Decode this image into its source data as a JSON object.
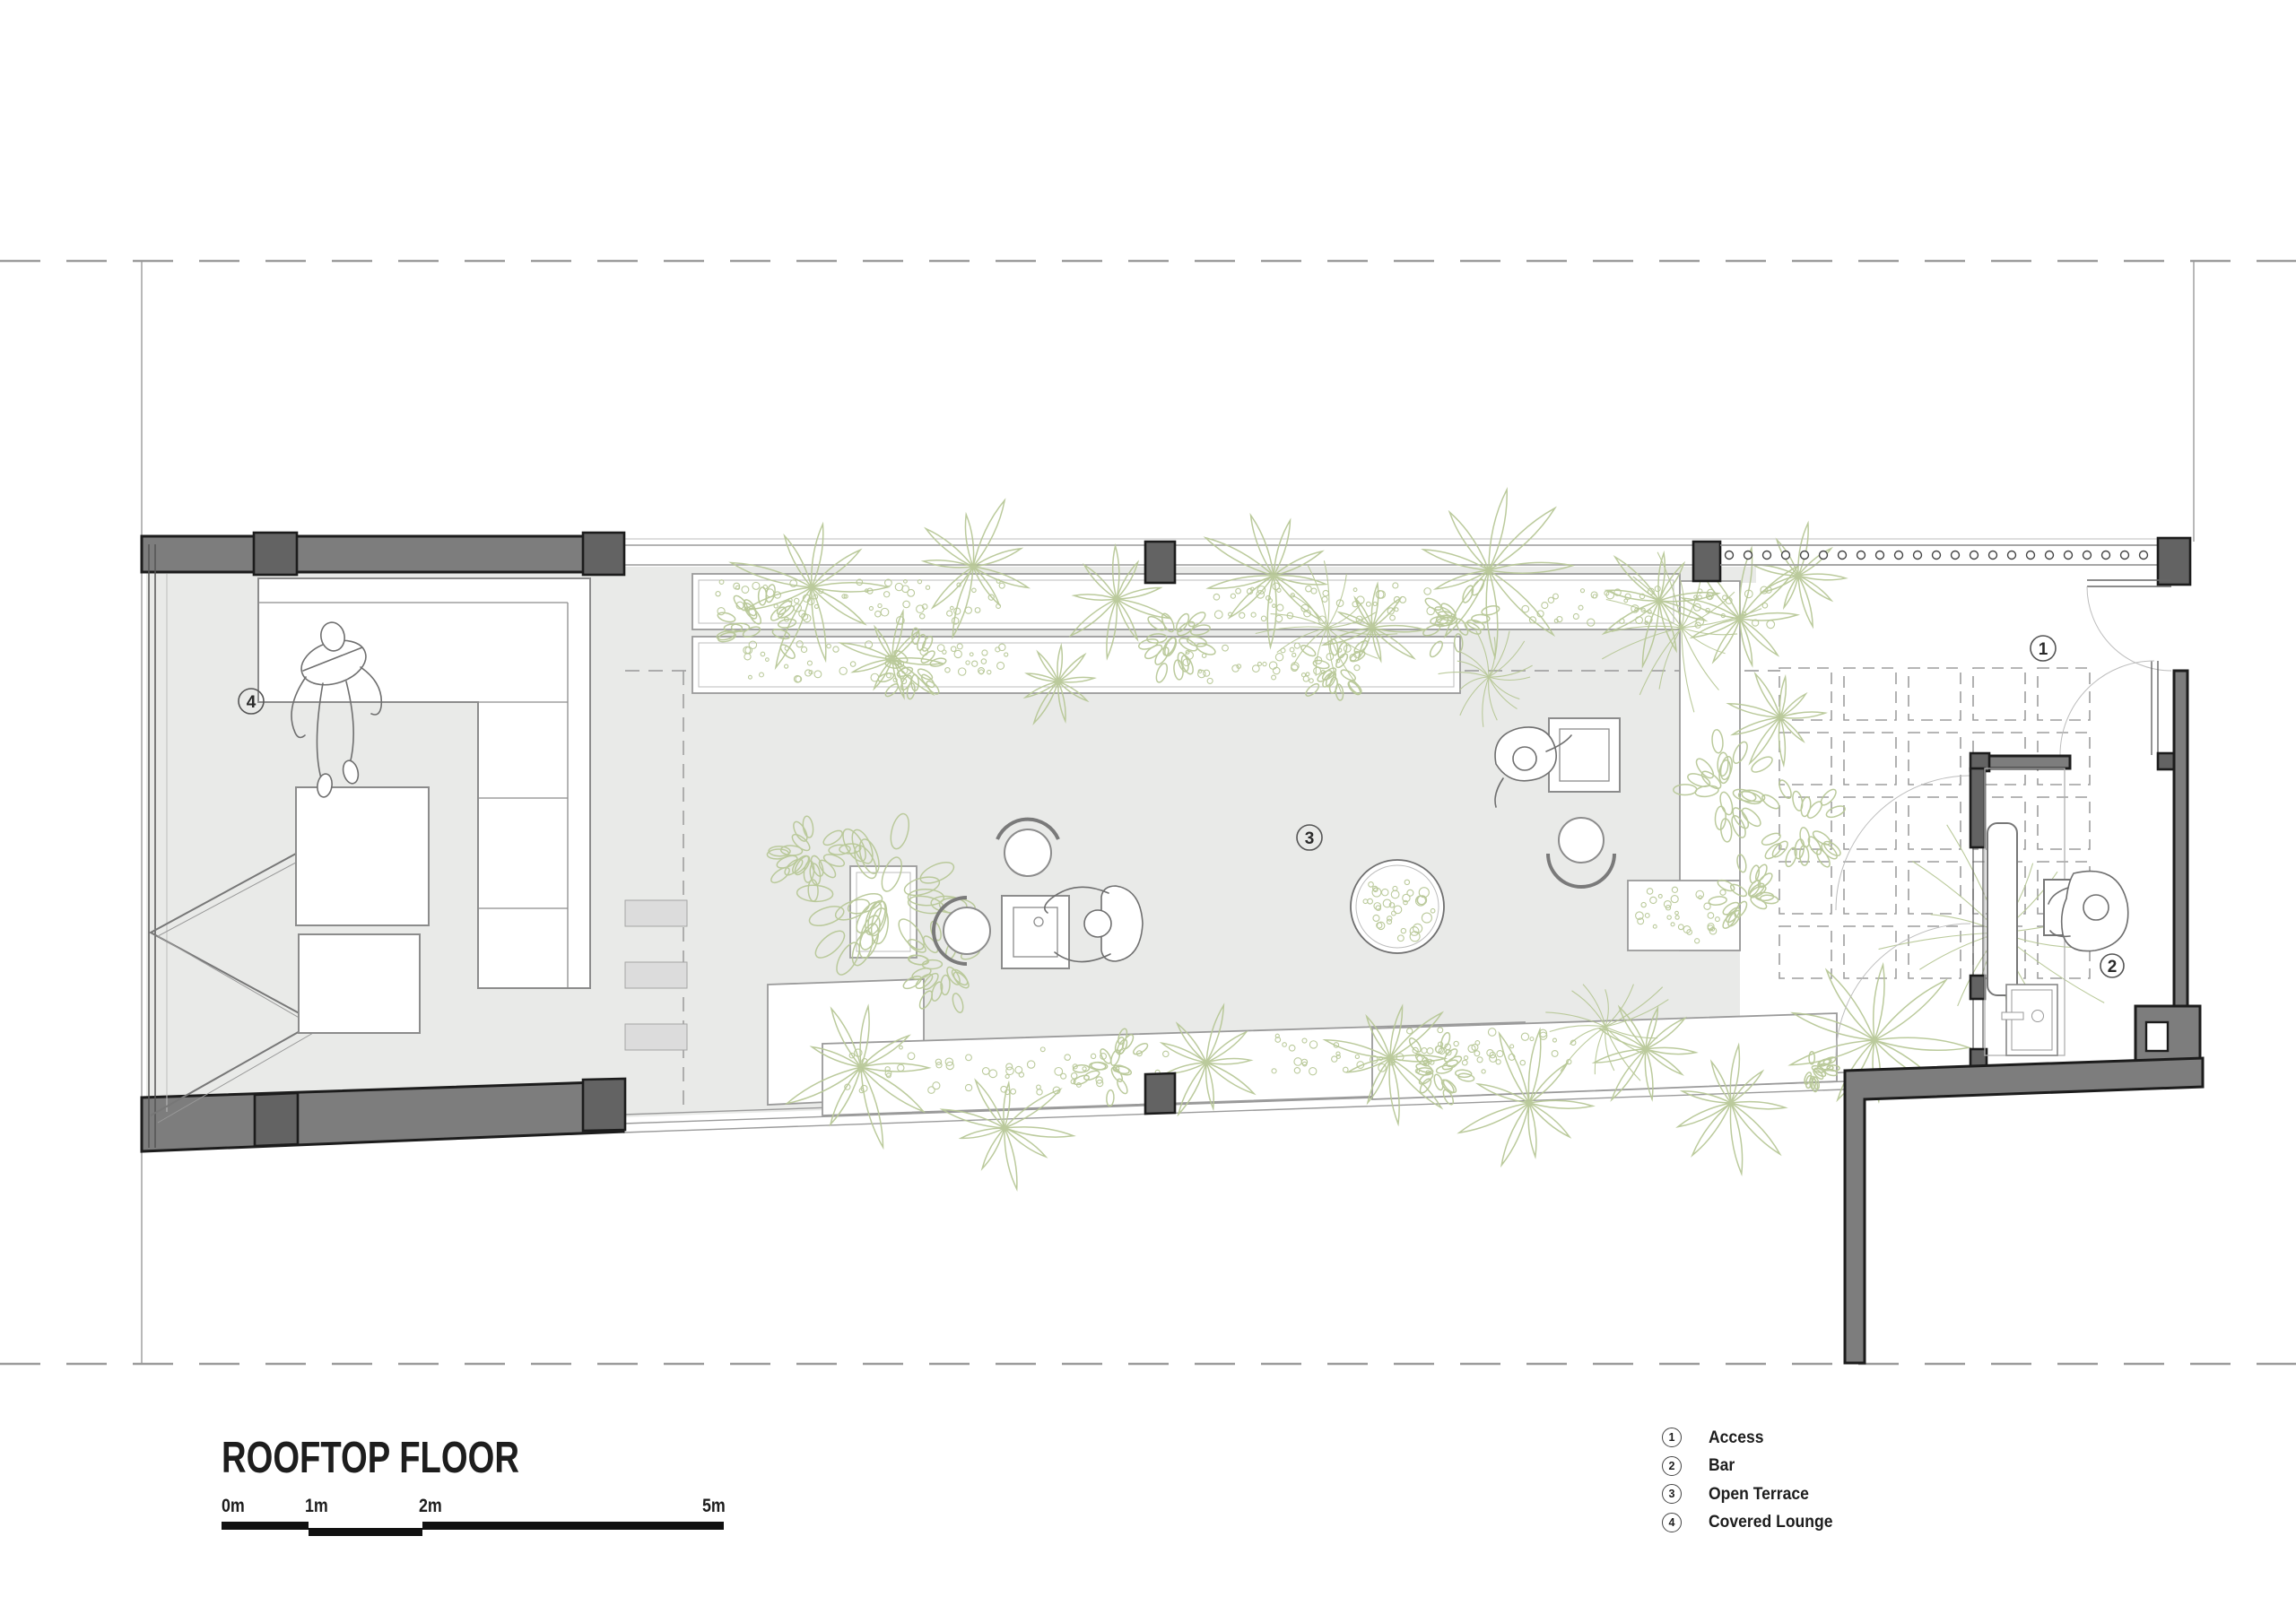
{
  "title": "ROOFTOP FLOOR",
  "scalebar": {
    "ticks": [
      "0m",
      "1m",
      "2m",
      "5m"
    ]
  },
  "legend": {
    "items": [
      {
        "num": "1",
        "label": "Access"
      },
      {
        "num": "2",
        "label": "Bar"
      },
      {
        "num": "3",
        "label": "Open Terrace"
      },
      {
        "num": "4",
        "label": "Covered Lounge"
      }
    ]
  },
  "plan_labels": {
    "access": "1",
    "bar": "2",
    "open_terrace": "3",
    "covered_lounge": "4"
  },
  "colors": {
    "wall_fill": "#7d7d7d",
    "column_fill": "#636363",
    "outline": "#1c1c1c",
    "floor_fill": "#e9eae8",
    "plant_green": "#b8c897",
    "thin_line": "#9a9a9a",
    "dash_line": "#9b9b9b",
    "text": "#1d1d1d",
    "paper": "#ffffff"
  }
}
